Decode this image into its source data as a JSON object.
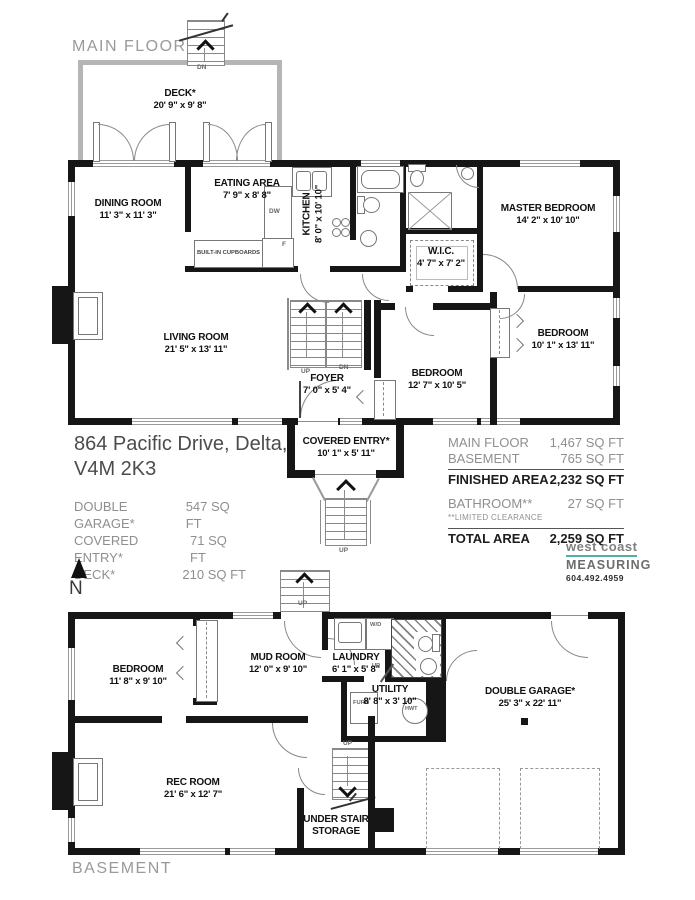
{
  "titles": {
    "main": "MAIN FLOOR",
    "basement": "BASEMENT"
  },
  "address": {
    "line1": "864 Pacific Drive, Delta,",
    "line2": "V4M 2K3"
  },
  "summary": {
    "rows": [
      {
        "label": "DOUBLE GARAGE*",
        "value": "547 SQ FT"
      },
      {
        "label": "COVERED ENTRY*",
        "value": "71 SQ FT"
      },
      {
        "label": "DECK*",
        "value": "210 SQ FT"
      }
    ]
  },
  "areas": {
    "rows": [
      {
        "label": "MAIN FLOOR",
        "value": "1,467 SQ FT"
      },
      {
        "label": "BASEMENT",
        "value": "765 SQ FT"
      },
      {
        "label": "FINISHED AREA",
        "value": "2,232 SQ FT"
      },
      {
        "label": "BATHROOM**",
        "value": "27 SQ FT"
      },
      {
        "label": "TOTAL AREA",
        "value": "2,259 SQ FT"
      }
    ],
    "note": "**LIMITED CLEARANCE"
  },
  "logo": {
    "line1": "west coast",
    "line2": "MEASURING",
    "phone": "604.492.4959",
    "accent": "#4FAFA8"
  },
  "compass": {
    "label": "N"
  },
  "rooms": {
    "deck": {
      "name": "DECK*",
      "dims": "20' 9\" x 9' 8\""
    },
    "dining": {
      "name": "DINING ROOM",
      "dims": "11' 3\" x 11' 3\""
    },
    "eating": {
      "name": "EATING AREA",
      "dims": "7' 9\" x 8' 8\""
    },
    "kitchen": {
      "name": "KITCHEN",
      "dims": "8' 0\" x 10' 10\""
    },
    "wic": {
      "name": "W.I.C.",
      "dims": "4' 7\" x 7' 2\""
    },
    "master": {
      "name": "MASTER BEDROOM",
      "dims": "14' 2\" x 10' 10\""
    },
    "living": {
      "name": "LIVING ROOM",
      "dims": "21' 5\" x 13' 11\""
    },
    "foyer": {
      "name": "FOYER",
      "dims": "7' 0\" x 5' 4\""
    },
    "bedroom2": {
      "name": "BEDROOM",
      "dims": "12' 7\" x 10' 5\""
    },
    "bedroom3": {
      "name": "BEDROOM",
      "dims": "10' 1\" x 13' 11\""
    },
    "entry": {
      "name": "COVERED ENTRY*",
      "dims": "10' 1\" x 5' 11\""
    },
    "bbedroom": {
      "name": "BEDROOM",
      "dims": "11' 8\" x 9' 10\""
    },
    "mud": {
      "name": "MUD ROOM",
      "dims": "12' 0\" x 9' 10\""
    },
    "laundry": {
      "name": "LAUNDRY",
      "dims": "6' 1\" x 5' 8\""
    },
    "utility": {
      "name": "UTILITY",
      "dims": "8' 8\" x 3' 10\""
    },
    "garage": {
      "name": "DOUBLE GARAGE*",
      "dims": "25' 3\" x  22' 11\""
    },
    "rec": {
      "name": "REC ROOM",
      "dims": "21' 6\" x 12' 7\""
    },
    "storage": {
      "line1": "UNDER STAIR",
      "line2": "STORAGE"
    }
  },
  "ann": {
    "up": "UP",
    "dn": "DN",
    "dw": "DW",
    "fridge": "F",
    "cupboards": "BUILT-IN CUPBOARDS",
    "wd": "W/D",
    "furn": "FURN",
    "hwt": "HWT"
  }
}
